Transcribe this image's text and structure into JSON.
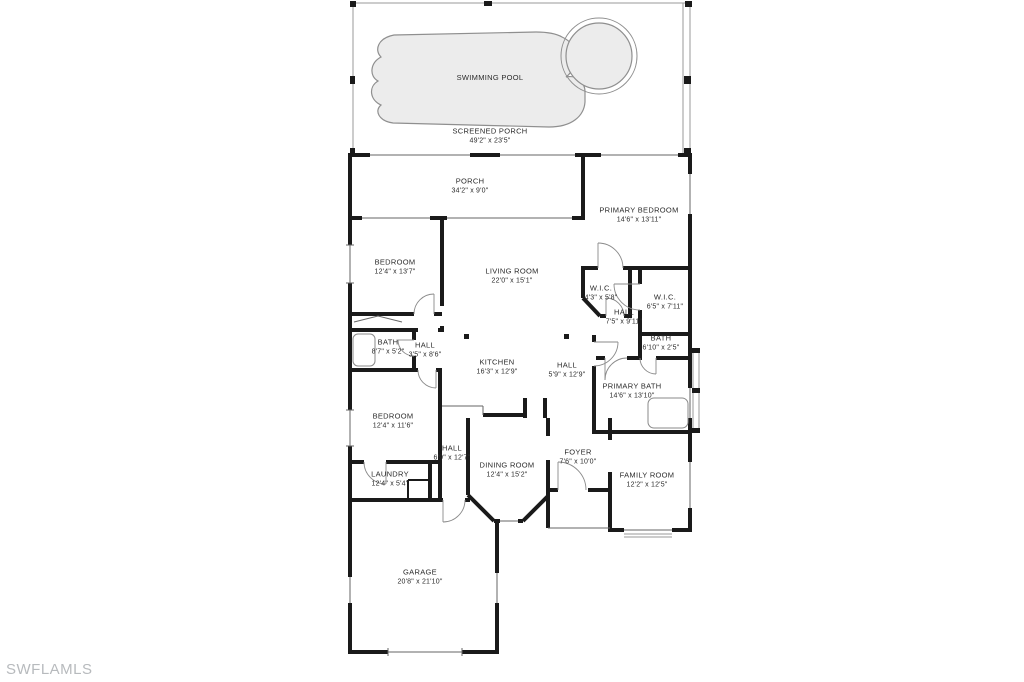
{
  "watermark": "SWFLAMLS",
  "colors": {
    "wall": "#1a1a1a",
    "pool_fill": "#ececec",
    "pool_stroke": "#8f8f8f",
    "screen": "#9a9a9a",
    "watermark": "#b7babd"
  },
  "rooms": [
    {
      "id": "swimming-pool",
      "name": "SWIMMING POOL",
      "dims": ""
    },
    {
      "id": "screened-porch",
      "name": "SCREENED PORCH",
      "dims": "49'2\" x 23'5\""
    },
    {
      "id": "porch",
      "name": "PORCH",
      "dims": "34'2\" x 9'0\""
    },
    {
      "id": "primary-bedroom",
      "name": "PRIMARY BEDROOM",
      "dims": "14'6\" x 13'11\""
    },
    {
      "id": "bedroom-1",
      "name": "BEDROOM",
      "dims": "12'4\" x 13'7\""
    },
    {
      "id": "living-room",
      "name": "LIVING ROOM",
      "dims": "22'0\" x 15'1\""
    },
    {
      "id": "wic-1",
      "name": "W.I.C.",
      "dims": "4'3\" x 5'8\""
    },
    {
      "id": "wic-2",
      "name": "W.I.C.",
      "dims": "6'5\" x 7'11\""
    },
    {
      "id": "hall-1",
      "name": "HALL",
      "dims": "7'5\" x 9'11\""
    },
    {
      "id": "bath-1",
      "name": "BATH",
      "dims": "8'7\" x 5'2\""
    },
    {
      "id": "hall-2",
      "name": "HALL",
      "dims": "3'5\" x 8'6\""
    },
    {
      "id": "bath-2",
      "name": "BATH",
      "dims": "6'10\" x 2'5\""
    },
    {
      "id": "kitchen",
      "name": "KITCHEN",
      "dims": "16'3\" x 12'9\""
    },
    {
      "id": "hall-3",
      "name": "HALL",
      "dims": "5'9\" x 12'9\""
    },
    {
      "id": "primary-bath",
      "name": "PRIMARY BATH",
      "dims": "14'6\" x 13'10\""
    },
    {
      "id": "bedroom-2",
      "name": "BEDROOM",
      "dims": "12'4\" x 11'6\""
    },
    {
      "id": "hall-4",
      "name": "HALL",
      "dims": "6'9\" x 12'7\""
    },
    {
      "id": "foyer",
      "name": "FOYER",
      "dims": "7'6\" x 10'0\""
    },
    {
      "id": "dining-room",
      "name": "DINING ROOM",
      "dims": "12'4\" x 15'2\""
    },
    {
      "id": "family-room",
      "name": "FAMILY ROOM",
      "dims": "12'2\" x 12'5\""
    },
    {
      "id": "laundry",
      "name": "LAUNDRY",
      "dims": "12'4\" x 5'4\""
    },
    {
      "id": "garage",
      "name": "GARAGE",
      "dims": "20'8\" x 21'10\""
    }
  ]
}
